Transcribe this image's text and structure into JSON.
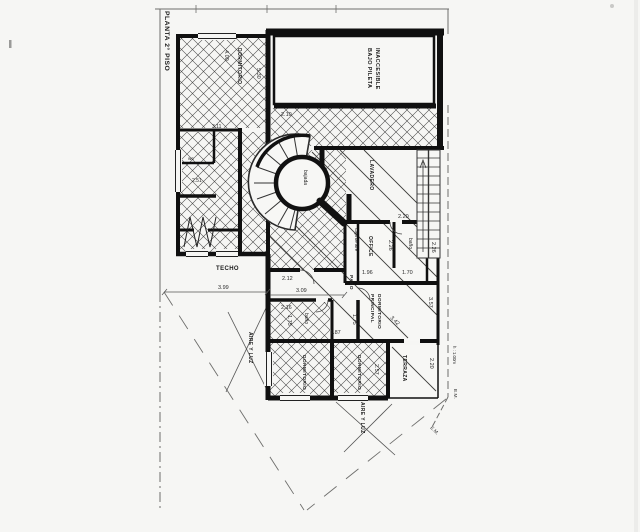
{
  "page": {
    "background": "#f6f6f4",
    "ink": "#111111",
    "hatch_color": "#4a4a4a"
  },
  "title": "PLANTA 2° PISO",
  "rooms": {
    "dormitorio_upper": "DORMITORIO",
    "bajo_pileta_l1": "BAJO PILETA",
    "bajo_pileta_l2": "INACCESIBLE",
    "wc": "wc",
    "bajada": "bajada",
    "lavadero": "LAVADERO",
    "caja_de_aire": "Caja de aire",
    "office": "OFFICE",
    "banio_top": "baño",
    "banio_mid": "baño",
    "paso": "PASO",
    "techo": "TECHO",
    "dorm_ppal_l1": "DORMITORIO",
    "dorm_ppal_l2": "PRINCIPAL",
    "dormitorio_b1": "DORMITORIO",
    "dormitorio_b2": "DORMITORIO",
    "terraza": "TERRAZA",
    "aire_luz_left": "AIRE Y LUZ",
    "aire_luz_bottom": "AIRE Y LUZ"
  },
  "dims": {
    "d400": "4.00",
    "d530": "5.30",
    "d210": "2.10",
    "d311": "3.11",
    "d251": "2.51",
    "d399": "3.99",
    "d212": "2.12",
    "d309": "3.09",
    "d216": "2.16",
    "d175a": "1.75",
    "d175b": "1.75",
    "d187": "1.87",
    "d196": "1.96",
    "d170": "1.70",
    "d226a": "2.26",
    "d226b": "2.26",
    "d220a": "2.20",
    "d220b": "2.20",
    "d342": "3.42",
    "d357": "3.57",
    "d257": "2.57",
    "h100": "h : 1.00m",
    "em1": "E.M.",
    "em2": "E.M."
  }
}
